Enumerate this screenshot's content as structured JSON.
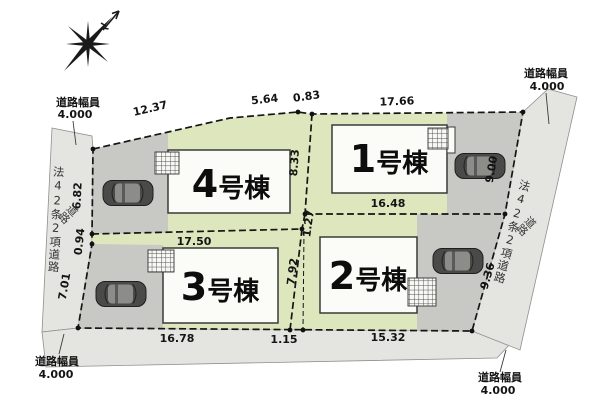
{
  "colors": {
    "lot_green": "#dde6bd",
    "parking_gray": "#c8c8c5",
    "road_gray": "#e4e4e0",
    "building_fill": "#fbfbf7"
  },
  "compass": {
    "icon": "compass-star",
    "north_icon": "north-arrow"
  },
  "road_width_annotations": {
    "top_left": {
      "label": "道路幅員",
      "value": "4.000"
    },
    "top_right": {
      "label": "道路幅員",
      "value": "4.000"
    },
    "bottom_left": {
      "label": "道路幅員",
      "value": "4.000"
    },
    "bottom_right": {
      "label": "道路幅員",
      "value": "4.000"
    }
  },
  "roads": {
    "left": {
      "name": "法42条2項道路",
      "surface_label": "道路"
    },
    "right": {
      "name": "法42条2項道路",
      "surface_label": "道路"
    }
  },
  "lots": {
    "lot1": {
      "label": "1号棟",
      "number": "1",
      "suffix": "号棟"
    },
    "lot2": {
      "label": "2号棟",
      "number": "2",
      "suffix": "号棟"
    },
    "lot3": {
      "label": "3号棟",
      "number": "3",
      "suffix": "号棟"
    },
    "lot4": {
      "label": "4号棟",
      "number": "4",
      "suffix": "号棟"
    }
  },
  "dimensions": {
    "top_seg1": "12.37",
    "top_seg2": "5.64",
    "top_seg3": "0.83",
    "lot1_top": "17.66",
    "left_upper": "6.82",
    "left_jog": "0.94",
    "left_lower": "7.01",
    "right_upper": "9.00",
    "right_lower": "9.36",
    "lot4_lot1_divider": "8.33",
    "divider_jog": "1.27",
    "lot3_lot2_divider": "7.92",
    "lot3_top": "17.50",
    "lot1_bottom": "16.48",
    "lot3_bottom": "16.78",
    "bottom_jog": "1.15",
    "lot2_bottom": "15.32"
  }
}
